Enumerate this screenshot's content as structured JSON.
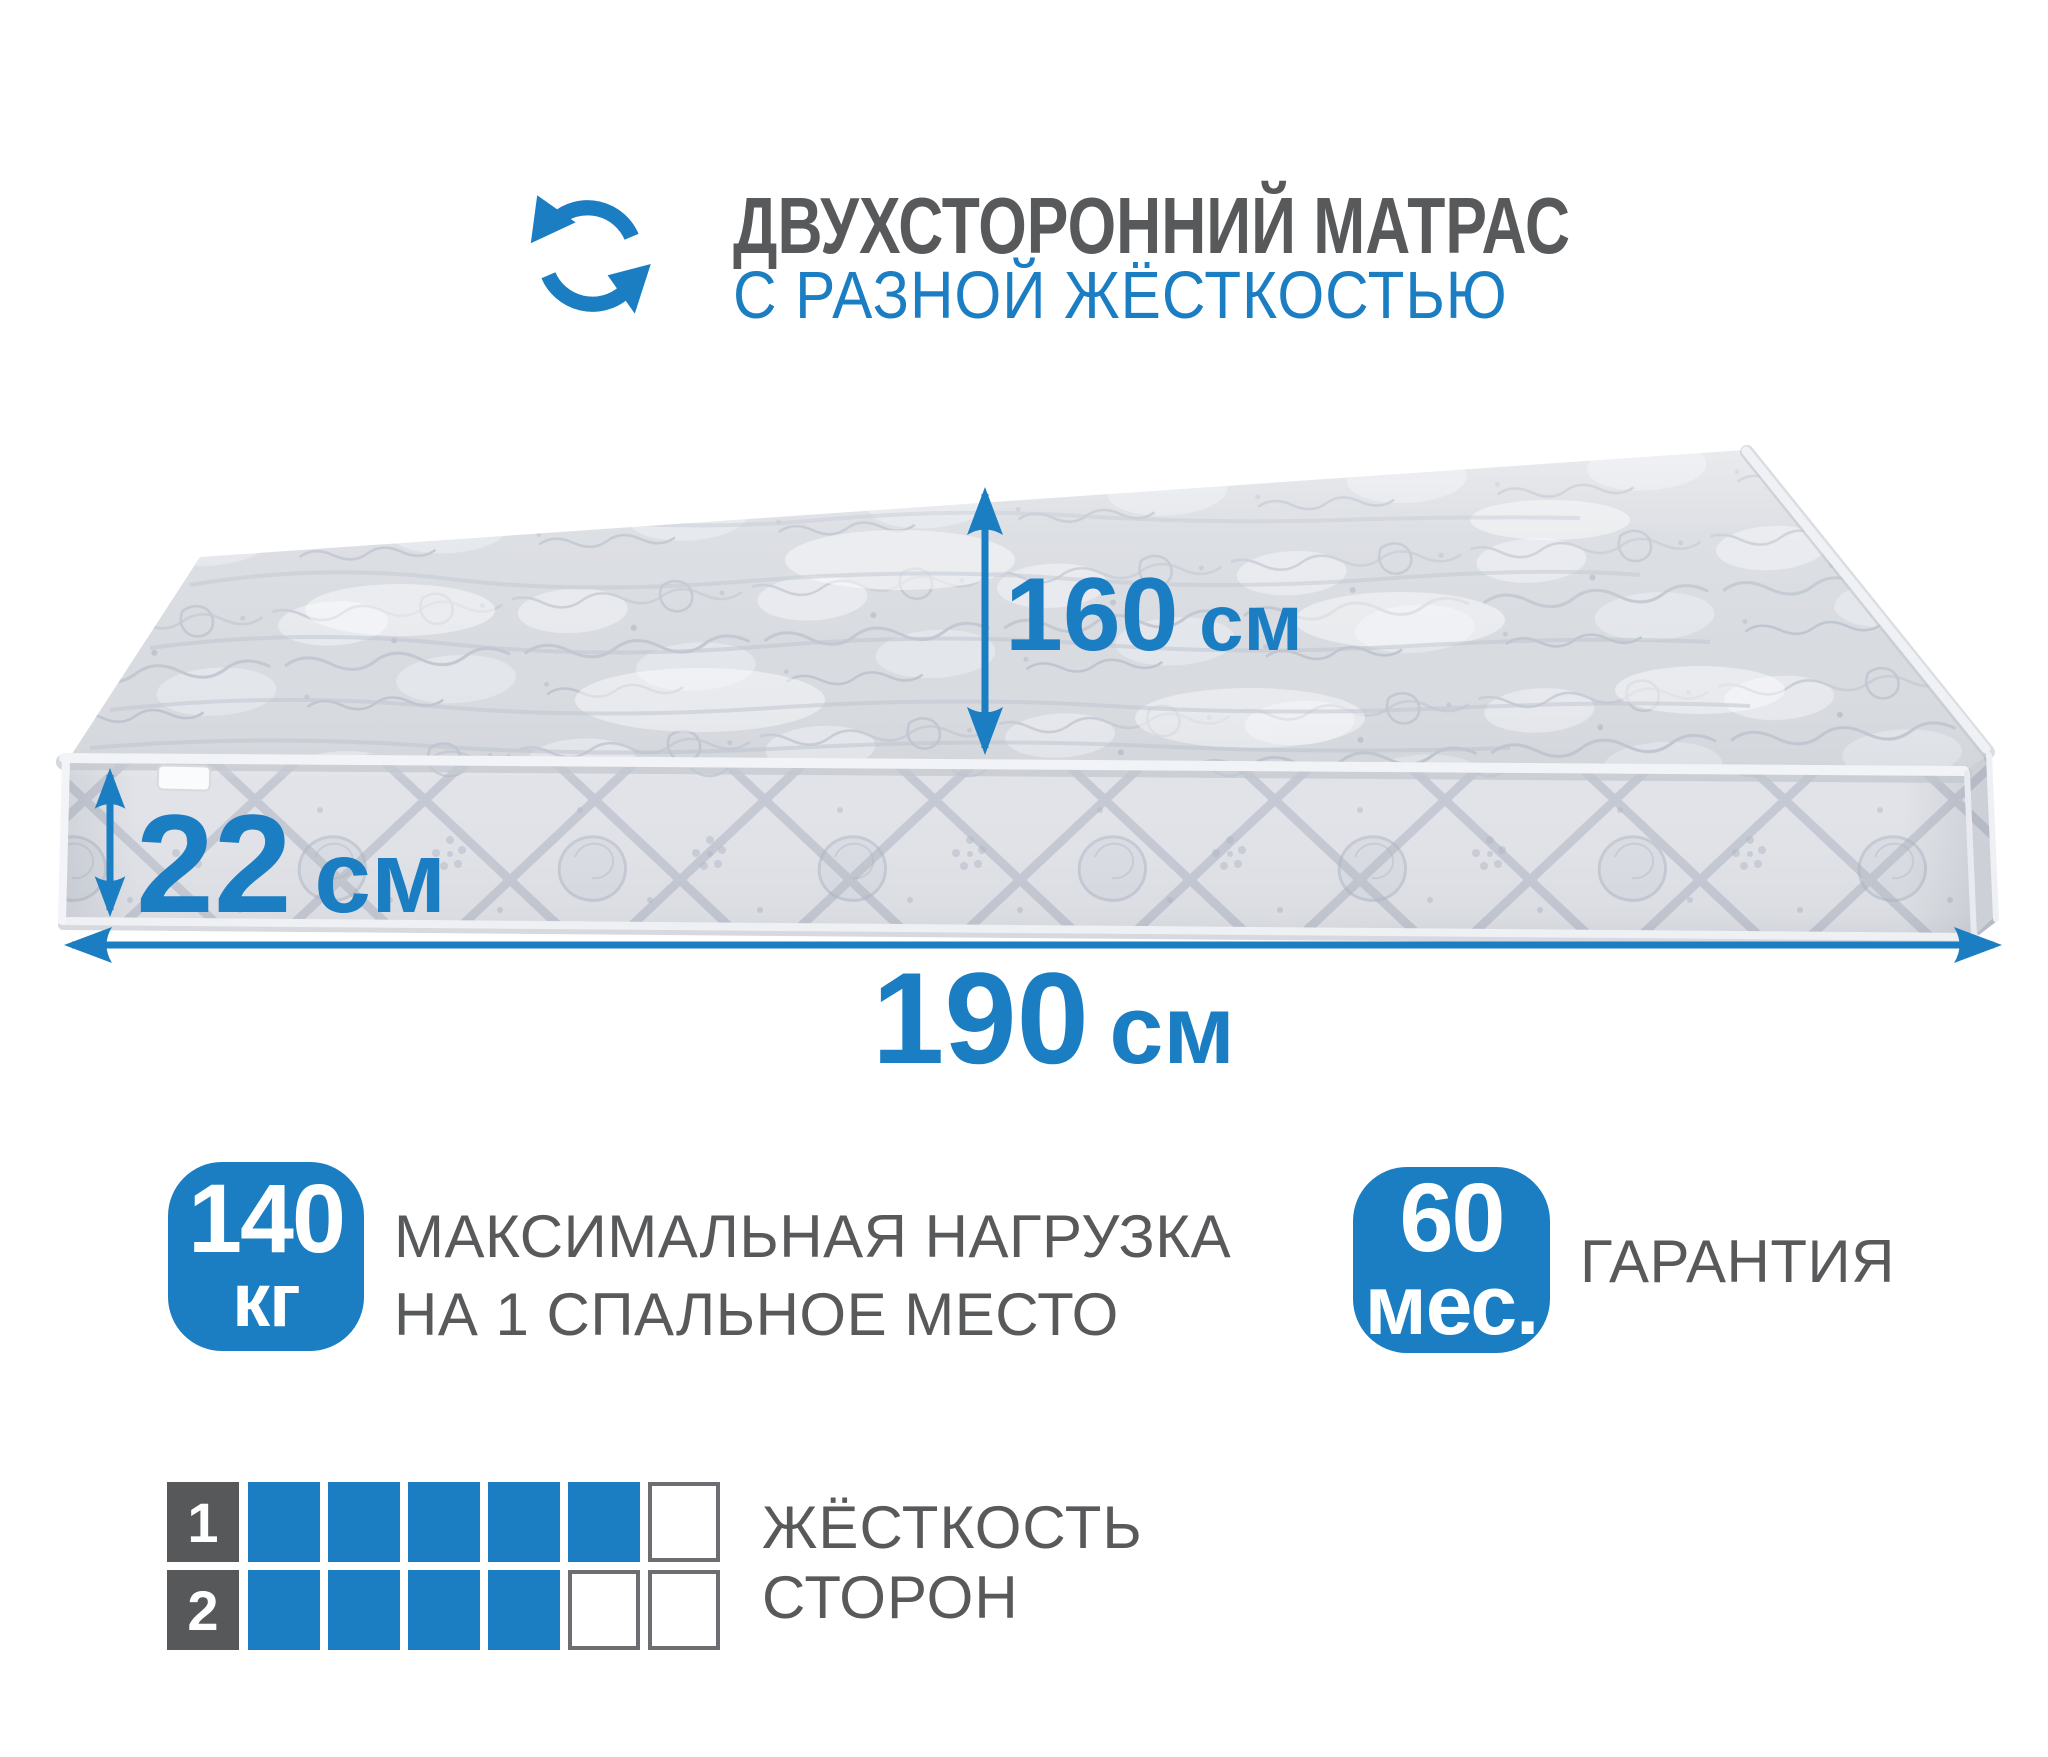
{
  "header": {
    "icon": "rotate-arrows-icon",
    "title": "ДВУХСТОРОННИЙ МАТРАС",
    "subtitle": "С РАЗНОЙ ЖЁСТКОСТЬЮ"
  },
  "colors": {
    "accent_blue": "#1b7dc2",
    "text_gray": "#58595b",
    "label_square_gray": "#57585a",
    "empty_square_border": "#6d6e71"
  },
  "mattress": {
    "top_width_label": {
      "value": "160",
      "unit": "см"
    },
    "height_label": {
      "value": "22",
      "unit": "см"
    },
    "length_label": {
      "value": "190",
      "unit": "см"
    }
  },
  "badges": {
    "max_load": {
      "value": "140",
      "unit": "кг",
      "caption_line1": "МАКСИМАЛЬНАЯ НАГРУЗКА",
      "caption_line2": "НА 1 СПАЛЬНОЕ МЕСТО"
    },
    "warranty": {
      "value": "60",
      "unit": "мес.",
      "caption": "ГАРАНТИЯ"
    }
  },
  "firmness_scale": {
    "caption_line1": "ЖЁСТКОСТЬ",
    "caption_line2": "СТОРОН",
    "rows": [
      {
        "side": "1",
        "filled": 5,
        "total": 6
      },
      {
        "side": "2",
        "filled": 4,
        "total": 6
      }
    ]
  }
}
